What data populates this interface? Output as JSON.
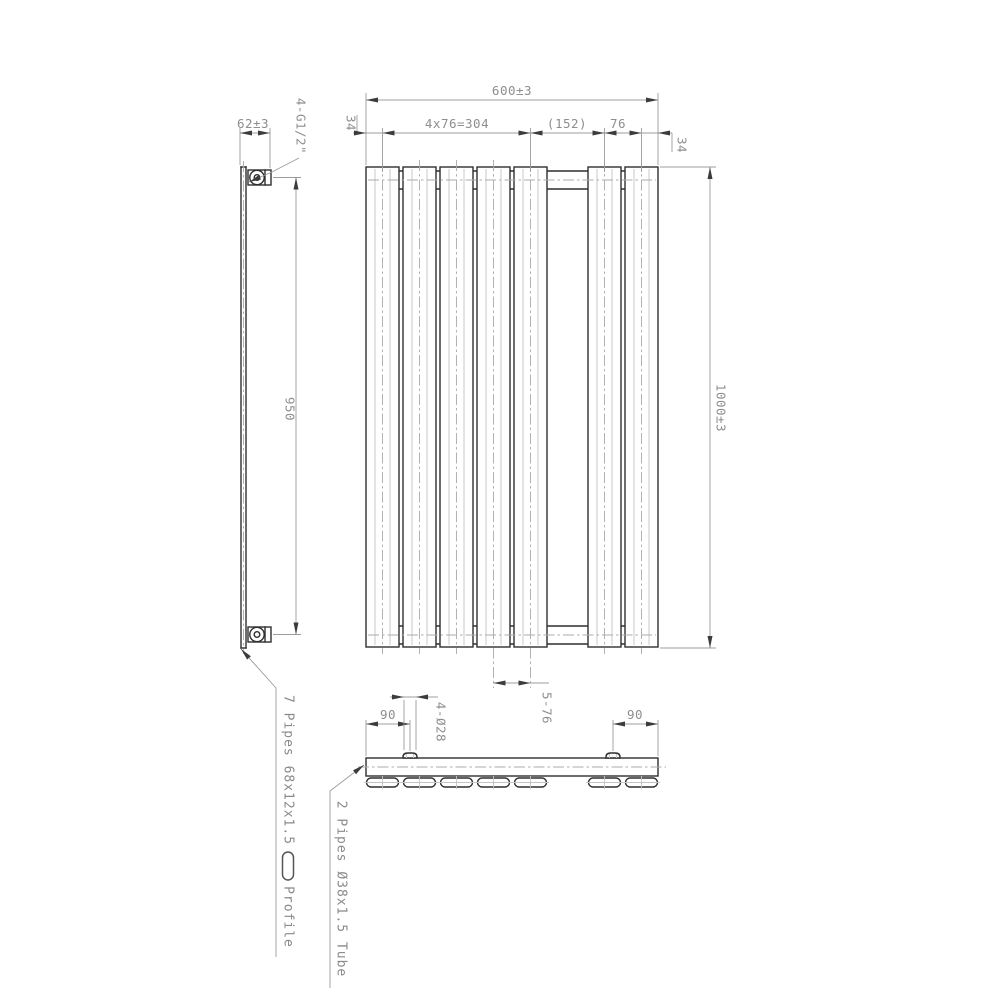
{
  "colors": {
    "background": "#ffffff",
    "part_outline": "#2f2f2f",
    "dimension_lines": "#9c9c9c",
    "dimension_text": "#8e8e8e",
    "centerlines": "#ababab"
  },
  "views": {
    "side": {
      "dims": {
        "depth": "62±3",
        "connections_thread": "4-G1/2\"",
        "pipe_centers": "950"
      }
    },
    "front": {
      "dims": {
        "overall_width": "600±3",
        "edge_offset_left": "34",
        "panel_pitch_group": "4x76=304",
        "center_gap": "(152)",
        "panel_pitch": "76",
        "edge_offset_right": "34",
        "overall_height": "1000±3",
        "bottom_pitch": "5-76"
      }
    },
    "bottom": {
      "dims": {
        "boss_offset_left": "90",
        "boss_offset_right": "90",
        "boss_diameter": "4-Ø28"
      }
    }
  },
  "callouts": {
    "panel_note": "7 Pipes 68x12x1.5",
    "profile_label": "Profile",
    "tube_note": "2 Pipes Ø38x1.5 Tube"
  }
}
